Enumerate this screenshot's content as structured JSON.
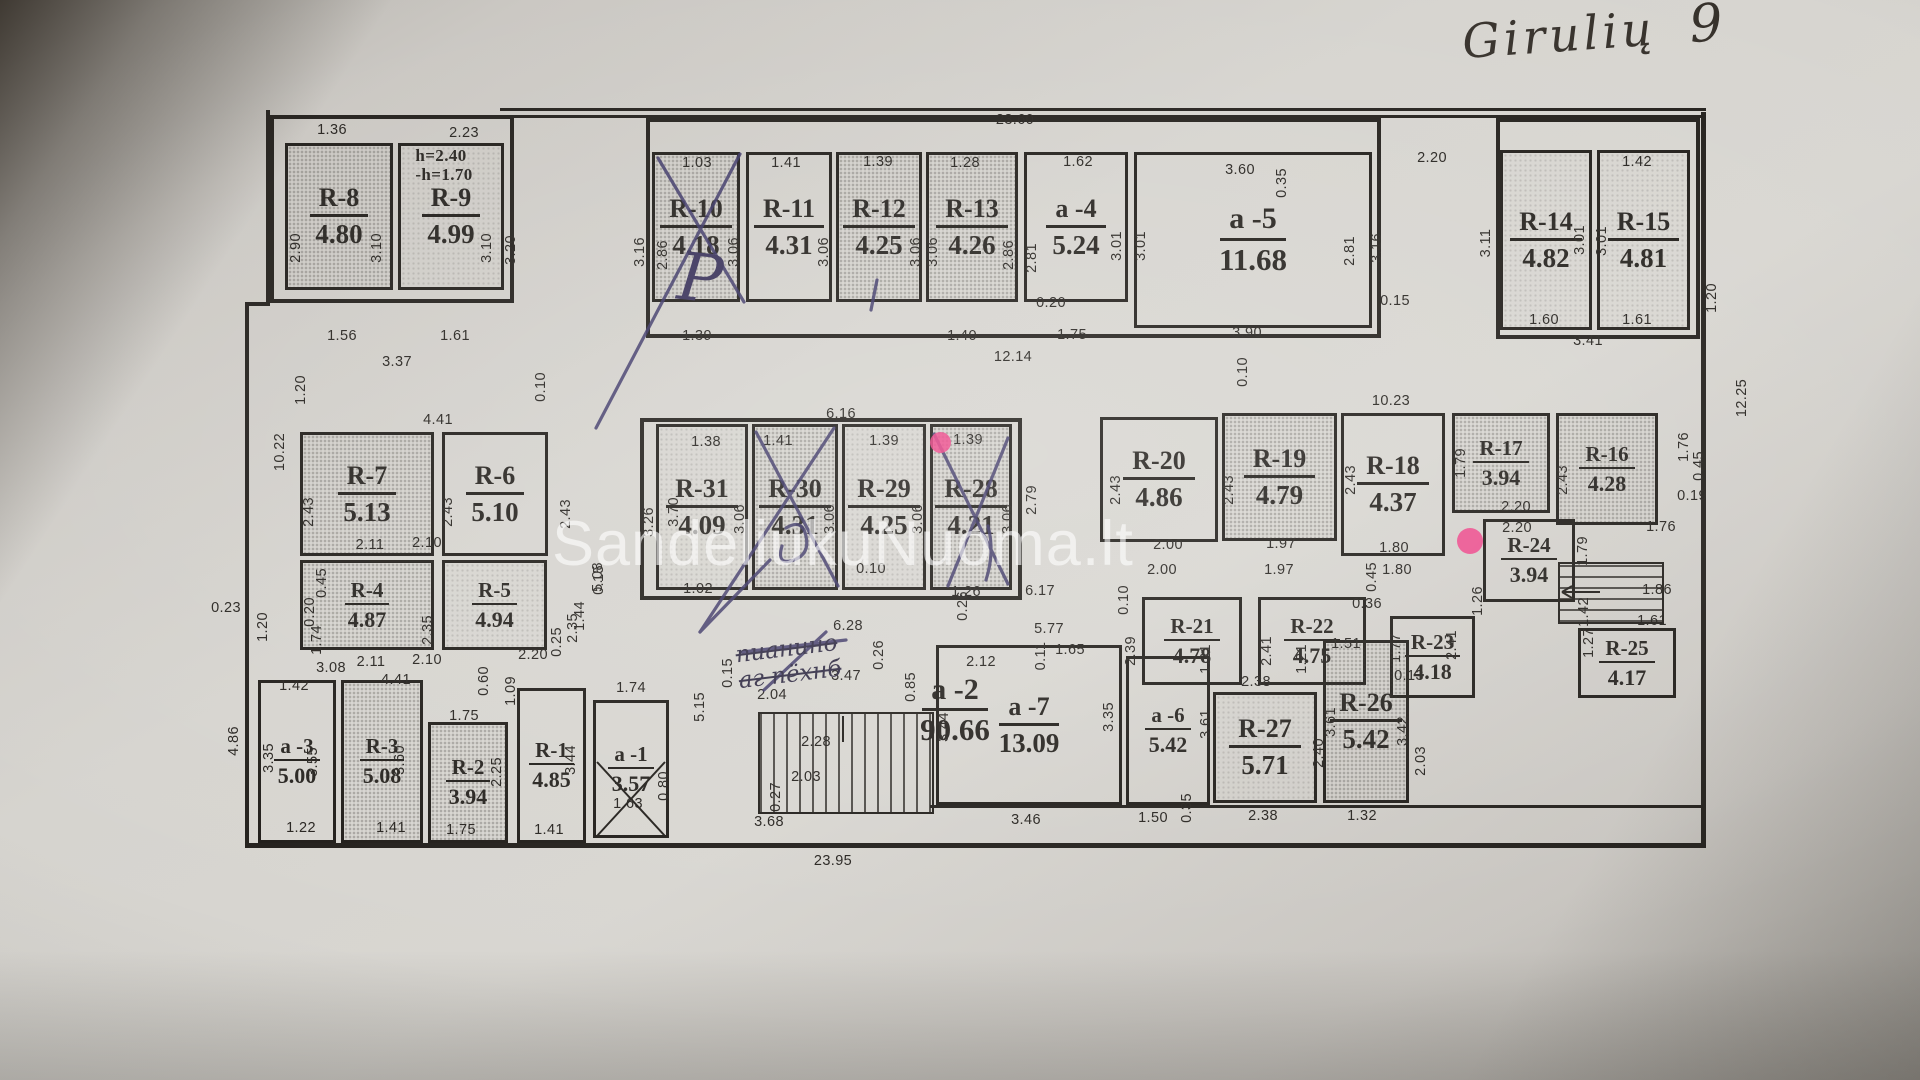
{
  "meta": {
    "handwritten_title_word": "Girulių",
    "handwritten_title_number": "9",
    "watermark": "SandeliukuNuoma.lt",
    "pen_letter": "P",
    "scribble_line1": "пианино",
    "scribble_line2": "аг пёхнб"
  },
  "height_note": {
    "dim": "2.23",
    "line1": "h=2.40",
    "line2": "-h=1.70"
  },
  "overall": {
    "top": "23.60",
    "bottom": "23.95",
    "right": "12.25",
    "left": "10.22"
  },
  "rooms": [
    {
      "n": "R-8",
      "a": "4.80",
      "x": 285,
      "y": 143,
      "w": 108,
      "h": 147,
      "s": 2
    },
    {
      "n": "R-9",
      "a": "4.99",
      "x": 398,
      "y": 143,
      "w": 106,
      "h": 147,
      "s": 1
    },
    {
      "n": "R-10",
      "a": "4.18",
      "x": 652,
      "y": 152,
      "w": 88,
      "h": 150,
      "s": 2
    },
    {
      "n": "R-11",
      "a": "4.31",
      "x": 746,
      "y": 152,
      "w": 86,
      "h": 150,
      "s": 0
    },
    {
      "n": "R-12",
      "a": "4.25",
      "x": 836,
      "y": 152,
      "w": 86,
      "h": 150,
      "s": 2
    },
    {
      "n": "R-13",
      "a": "4.26",
      "x": 926,
      "y": 152,
      "w": 92,
      "h": 150,
      "s": 2
    },
    {
      "n": "a -4",
      "a": "5.24",
      "x": 1024,
      "y": 152,
      "w": 104,
      "h": 150,
      "s": 0
    },
    {
      "n": "a -5",
      "a": "11.68",
      "x": 1134,
      "y": 152,
      "w": 238,
      "h": 176,
      "s": 0,
      "lg": true
    },
    {
      "n": "R-14",
      "a": "4.82",
      "x": 1500,
      "y": 150,
      "w": 92,
      "h": 180,
      "s": 1
    },
    {
      "n": "R-15",
      "a": "4.81",
      "x": 1597,
      "y": 150,
      "w": 93,
      "h": 180,
      "s": 1
    },
    {
      "n": "R-7",
      "a": "5.13",
      "x": 300,
      "y": 432,
      "w": 134,
      "h": 124,
      "s": 2
    },
    {
      "n": "R-6",
      "a": "5.10",
      "x": 442,
      "y": 432,
      "w": 106,
      "h": 124,
      "s": 0
    },
    {
      "n": "R-4",
      "a": "4.87",
      "x": 300,
      "y": 560,
      "w": 134,
      "h": 90,
      "s": 2,
      "sm": true
    },
    {
      "n": "R-5",
      "a": "4.94",
      "x": 442,
      "y": 560,
      "w": 105,
      "h": 90,
      "s": 1,
      "sm": true
    },
    {
      "n": "R-31",
      "a": "4.09",
      "x": 656,
      "y": 424,
      "w": 92,
      "h": 166,
      "s": 1
    },
    {
      "n": "R-30",
      "a": "4.31",
      "x": 752,
      "y": 424,
      "w": 86,
      "h": 166,
      "s": 2
    },
    {
      "n": "R-29",
      "a": "4.25",
      "x": 842,
      "y": 424,
      "w": 84,
      "h": 166,
      "s": 1
    },
    {
      "n": "R-28",
      "a": "4.21",
      "x": 930,
      "y": 424,
      "w": 82,
      "h": 166,
      "s": 2
    },
    {
      "n": "R-20",
      "a": "4.86",
      "x": 1100,
      "y": 417,
      "w": 118,
      "h": 125,
      "s": 0
    },
    {
      "n": "R-19",
      "a": "4.79",
      "x": 1222,
      "y": 413,
      "w": 115,
      "h": 128,
      "s": 2
    },
    {
      "n": "R-18",
      "a": "4.37",
      "x": 1341,
      "y": 413,
      "w": 104,
      "h": 143,
      "s": 0
    },
    {
      "n": "R-17",
      "a": "3.94",
      "x": 1452,
      "y": 413,
      "w": 98,
      "h": 100,
      "s": 2,
      "sm": true
    },
    {
      "n": "R-16",
      "a": "4.28",
      "x": 1556,
      "y": 413,
      "w": 102,
      "h": 112,
      "s": 2,
      "sm": true
    },
    {
      "n": "R-24",
      "a": "3.94",
      "x": 1483,
      "y": 519,
      "w": 92,
      "h": 83,
      "s": 0,
      "sm": true
    },
    {
      "n": "R-21",
      "a": "4.78",
      "x": 1142,
      "y": 597,
      "w": 100,
      "h": 88,
      "s": 0,
      "sm": true
    },
    {
      "n": "R-22",
      "a": "4.75",
      "x": 1258,
      "y": 597,
      "w": 108,
      "h": 88,
      "s": 0,
      "sm": true
    },
    {
      "n": "R-23",
      "a": "4.18",
      "x": 1390,
      "y": 616,
      "w": 85,
      "h": 82,
      "s": 0,
      "sm": true
    },
    {
      "n": "R-25",
      "a": "4.17",
      "x": 1578,
      "y": 628,
      "w": 98,
      "h": 70,
      "s": 0,
      "sm": true
    },
    {
      "n": "a -3",
      "a": "5.00",
      "x": 258,
      "y": 680,
      "w": 78,
      "h": 163,
      "s": 0,
      "sm": true
    },
    {
      "n": "R-3",
      "a": "5.08",
      "x": 341,
      "y": 680,
      "w": 82,
      "h": 163,
      "s": 2,
      "sm": true
    },
    {
      "n": "R-2",
      "a": "3.94",
      "x": 428,
      "y": 722,
      "w": 80,
      "h": 121,
      "s": 2,
      "sm": true
    },
    {
      "n": "R-1",
      "a": "4.85",
      "x": 517,
      "y": 688,
      "w": 69,
      "h": 155,
      "s": 0,
      "sm": true
    },
    {
      "n": "a -1",
      "a": "3.57",
      "x": 593,
      "y": 700,
      "w": 76,
      "h": 138,
      "s": 0,
      "sm": true
    },
    {
      "n": "a -2",
      "a": "90.66",
      "x": 885,
      "y": 668,
      "w": 140,
      "h": 85,
      "s": 0,
      "nb": true,
      "lg": true
    },
    {
      "n": "a -7",
      "a": "13.09",
      "x": 936,
      "y": 645,
      "w": 186,
      "h": 160,
      "s": 0
    },
    {
      "n": "a -6",
      "a": "5.42",
      "x": 1126,
      "y": 656,
      "w": 84,
      "h": 149,
      "s": 0,
      "sm": true
    },
    {
      "n": "R-27",
      "a": "5.71",
      "x": 1213,
      "y": 692,
      "w": 104,
      "h": 111,
      "s": 1
    },
    {
      "n": "R-26",
      "a": "5.42",
      "x": 1323,
      "y": 640,
      "w": 86,
      "h": 163,
      "s": 2
    }
  ],
  "dims": [
    [
      "23.60",
      1015,
      120,
      0
    ],
    [
      "1.36",
      332,
      130,
      0
    ],
    [
      "2.23",
      464,
      133,
      0
    ],
    [
      "1.03",
      697,
      163,
      0
    ],
    [
      "1.41",
      786,
      163,
      0
    ],
    [
      "1.39",
      878,
      162,
      0
    ],
    [
      "1.28",
      965,
      163,
      0
    ],
    [
      "1.62",
      1078,
      162,
      0
    ],
    [
      "3.60",
      1240,
      170,
      0
    ],
    [
      "0.35",
      1282,
      183,
      1
    ],
    [
      "2.20",
      1432,
      158,
      0
    ],
    [
      "1.42",
      1637,
      162,
      0
    ],
    [
      "2.90",
      296,
      248,
      1
    ],
    [
      "3.10",
      377,
      248,
      1
    ],
    [
      "3.10",
      487,
      248,
      1
    ],
    [
      "3.20",
      511,
      250,
      1
    ],
    [
      "3.16",
      640,
      252,
      1
    ],
    [
      "2.86",
      663,
      255,
      1
    ],
    [
      "3.06",
      734,
      252,
      1
    ],
    [
      "3.06",
      824,
      252,
      1
    ],
    [
      "3.06",
      916,
      252,
      1
    ],
    [
      "3.06",
      933,
      252,
      1
    ],
    [
      "2.86",
      1009,
      255,
      1
    ],
    [
      "2.81",
      1032,
      258,
      1
    ],
    [
      "3.01",
      1117,
      246,
      1
    ],
    [
      "3.01",
      1141,
      246,
      1
    ],
    [
      "2.81",
      1350,
      251,
      1
    ],
    [
      "3.16",
      1377,
      248,
      1
    ],
    [
      "3.11",
      1486,
      243,
      1
    ],
    [
      "3.01",
      1580,
      240,
      1
    ],
    [
      "3.01",
      1602,
      241,
      1
    ],
    [
      "1.56",
      342,
      336,
      0
    ],
    [
      "1.61",
      455,
      336,
      0
    ],
    [
      "3.37",
      397,
      362,
      0
    ],
    [
      "1.20",
      301,
      390,
      1
    ],
    [
      "10.22",
      280,
      452,
      1
    ],
    [
      "0.10",
      541,
      387,
      1
    ],
    [
      "1.39",
      697,
      336,
      0
    ],
    [
      "1.40",
      962,
      336,
      0
    ],
    [
      "0.20",
      1051,
      303,
      0
    ],
    [
      "1.75",
      1072,
      335,
      0
    ],
    [
      "12.14",
      1013,
      357,
      0
    ],
    [
      "3.90",
      1247,
      333,
      0
    ],
    [
      "0.15",
      1395,
      301,
      0
    ],
    [
      "0.10",
      1243,
      372,
      1
    ],
    [
      "1.60",
      1544,
      320,
      0
    ],
    [
      "1.61",
      1637,
      320,
      0
    ],
    [
      "3.41",
      1588,
      341,
      0
    ],
    [
      "1.20",
      1712,
      298,
      1
    ],
    [
      "12.25",
      1742,
      398,
      1
    ],
    [
      "4.41",
      438,
      420,
      0
    ],
    [
      "6.16",
      841,
      414,
      0
    ],
    [
      "1.38",
      706,
      442,
      0
    ],
    [
      "1.41",
      778,
      441,
      0
    ],
    [
      "1.39",
      884,
      441,
      0
    ],
    [
      "1.39",
      968,
      440,
      0
    ],
    [
      "10.23",
      1391,
      401,
      0
    ],
    [
      "2.43",
      309,
      512,
      1
    ],
    [
      "2.43",
      448,
      512,
      1
    ],
    [
      "2.43",
      566,
      514,
      1
    ],
    [
      "5.08",
      598,
      577,
      1
    ],
    [
      "3.26",
      649,
      522,
      1
    ],
    [
      "3.70",
      674,
      512,
      1
    ],
    [
      "3.06",
      740,
      519,
      1
    ],
    [
      "3.06",
      830,
      519,
      1
    ],
    [
      "3.06",
      918,
      519,
      1
    ],
    [
      "3.06",
      1008,
      519,
      1
    ],
    [
      "2.79",
      1032,
      500,
      1
    ],
    [
      "2.43",
      1116,
      490,
      1
    ],
    [
      "2.43",
      1229,
      490,
      1
    ],
    [
      "2.43",
      1351,
      480,
      1
    ],
    [
      "1.79",
      1461,
      463,
      1
    ],
    [
      "2.43",
      1563,
      480,
      1
    ],
    [
      "2.20",
      1516,
      507,
      0
    ],
    [
      "2.20",
      1517,
      528,
      0
    ],
    [
      "1.79",
      1583,
      551,
      1
    ],
    [
      "2.11",
      370,
      545,
      0
    ],
    [
      "2.10",
      427,
      543,
      0
    ],
    [
      "0.45",
      322,
      583,
      1
    ],
    [
      "0.20",
      310,
      612,
      1
    ],
    [
      "1.74",
      317,
      640,
      1
    ],
    [
      "2.35",
      428,
      630,
      1
    ],
    [
      "2.35",
      573,
      628,
      1
    ],
    [
      "2.11",
      371,
      662,
      0
    ],
    [
      "2.10",
      427,
      660,
      0
    ],
    [
      "4.41",
      396,
      680,
      0
    ],
    [
      "1.02",
      698,
      589,
      0
    ],
    [
      "0.10",
      871,
      569,
      0
    ],
    [
      "1.26",
      966,
      592,
      0
    ],
    [
      "6.28",
      848,
      626,
      0
    ],
    [
      "2.00",
      1168,
      545,
      0
    ],
    [
      "2.00",
      1162,
      570,
      0
    ],
    [
      "1.97",
      1281,
      544,
      0
    ],
    [
      "1.97",
      1279,
      570,
      0
    ],
    [
      "1.80",
      1394,
      548,
      0
    ],
    [
      "1.80",
      1397,
      570,
      0
    ],
    [
      "0.45",
      1372,
      577,
      1
    ],
    [
      "0.36",
      1367,
      604,
      0
    ],
    [
      "0.45",
      1699,
      466,
      1
    ],
    [
      "0.19",
      1692,
      496,
      0
    ],
    [
      "1.76",
      1684,
      447,
      1
    ],
    [
      "1.76",
      1661,
      527,
      0
    ],
    [
      "0.23",
      226,
      608,
      0
    ],
    [
      "1.20",
      263,
      627,
      1
    ],
    [
      "3.08",
      331,
      668,
      0
    ],
    [
      "1.42",
      294,
      686,
      0
    ],
    [
      "4.86",
      234,
      741,
      1
    ],
    [
      "3.35",
      269,
      758,
      1
    ],
    [
      "3.55",
      313,
      762,
      1
    ],
    [
      "3.60",
      400,
      760,
      1
    ],
    [
      "1.22",
      301,
      828,
      0
    ],
    [
      "1.41",
      391,
      828,
      0
    ],
    [
      "1.75",
      464,
      716,
      0
    ],
    [
      "2.25",
      497,
      772,
      1
    ],
    [
      "1.75",
      461,
      830,
      0
    ],
    [
      "0.60",
      484,
      681,
      1
    ],
    [
      "1.09",
      511,
      691,
      1
    ],
    [
      "2.20",
      533,
      655,
      0
    ],
    [
      "0.25",
      557,
      642,
      1
    ],
    [
      "1.44",
      580,
      616,
      1
    ],
    [
      "0.15",
      599,
      580,
      1
    ],
    [
      "3.44",
      571,
      760,
      1
    ],
    [
      "1.41",
      549,
      830,
      0
    ],
    [
      "1.74",
      631,
      688,
      0
    ],
    [
      "1.63",
      628,
      804,
      0
    ],
    [
      "0.80",
      664,
      786,
      1
    ],
    [
      "5.15",
      700,
      707,
      1
    ],
    [
      "0.15",
      728,
      673,
      1
    ],
    [
      "2.04",
      772,
      695,
      0
    ],
    [
      "3.47",
      846,
      676,
      0
    ],
    [
      "0.26",
      879,
      655,
      1
    ],
    [
      "0.85",
      911,
      687,
      1
    ],
    [
      "2.28",
      816,
      742,
      0
    ],
    [
      "2.03",
      806,
      777,
      0
    ],
    [
      "0.27",
      776,
      797,
      1
    ],
    [
      "3.68",
      769,
      822,
      0
    ],
    [
      "0.26",
      963,
      606,
      1
    ],
    [
      "6.17",
      1040,
      591,
      0
    ],
    [
      "0.10",
      1124,
      600,
      1
    ],
    [
      "5.77",
      1049,
      629,
      0
    ],
    [
      "2.12",
      981,
      662,
      0
    ],
    [
      "0.11",
      1041,
      656,
      1
    ],
    [
      "1.65",
      1070,
      650,
      0
    ],
    [
      "3.44",
      944,
      727,
      1
    ],
    [
      "3.35",
      1109,
      717,
      1
    ],
    [
      "3.46",
      1026,
      820,
      0
    ],
    [
      "1.50",
      1153,
      818,
      0
    ],
    [
      "0.35",
      1187,
      808,
      1
    ],
    [
      "1.21",
      1206,
      659,
      1
    ],
    [
      "1.21",
      1302,
      659,
      1
    ],
    [
      "2.38",
      1256,
      682,
      0
    ],
    [
      "2.38",
      1263,
      816,
      0
    ],
    [
      "3.61",
      1206,
      724,
      1
    ],
    [
      "2.40",
      1319,
      753,
      1
    ],
    [
      "1.51",
      1346,
      644,
      0
    ],
    [
      "0.13",
      1409,
      676,
      0
    ],
    [
      "3.61",
      1331,
      722,
      1
    ],
    [
      "3.42",
      1403,
      731,
      1
    ],
    [
      "1.32",
      1362,
      816,
      0
    ],
    [
      "2.03",
      1421,
      761,
      1
    ],
    [
      "2.39",
      1131,
      651,
      1
    ],
    [
      "2.41",
      1267,
      651,
      1
    ],
    [
      "1.77",
      1396,
      648,
      1
    ],
    [
      "2.41",
      1452,
      645,
      1
    ],
    [
      "1.26",
      1478,
      601,
      1
    ],
    [
      "1.86",
      1657,
      590,
      0
    ],
    [
      "1.61",
      1652,
      621,
      0
    ],
    [
      "1.42",
      1584,
      612,
      1
    ],
    [
      "1.27",
      1589,
      643,
      1
    ],
    [
      "23.95",
      833,
      861,
      0
    ]
  ]
}
